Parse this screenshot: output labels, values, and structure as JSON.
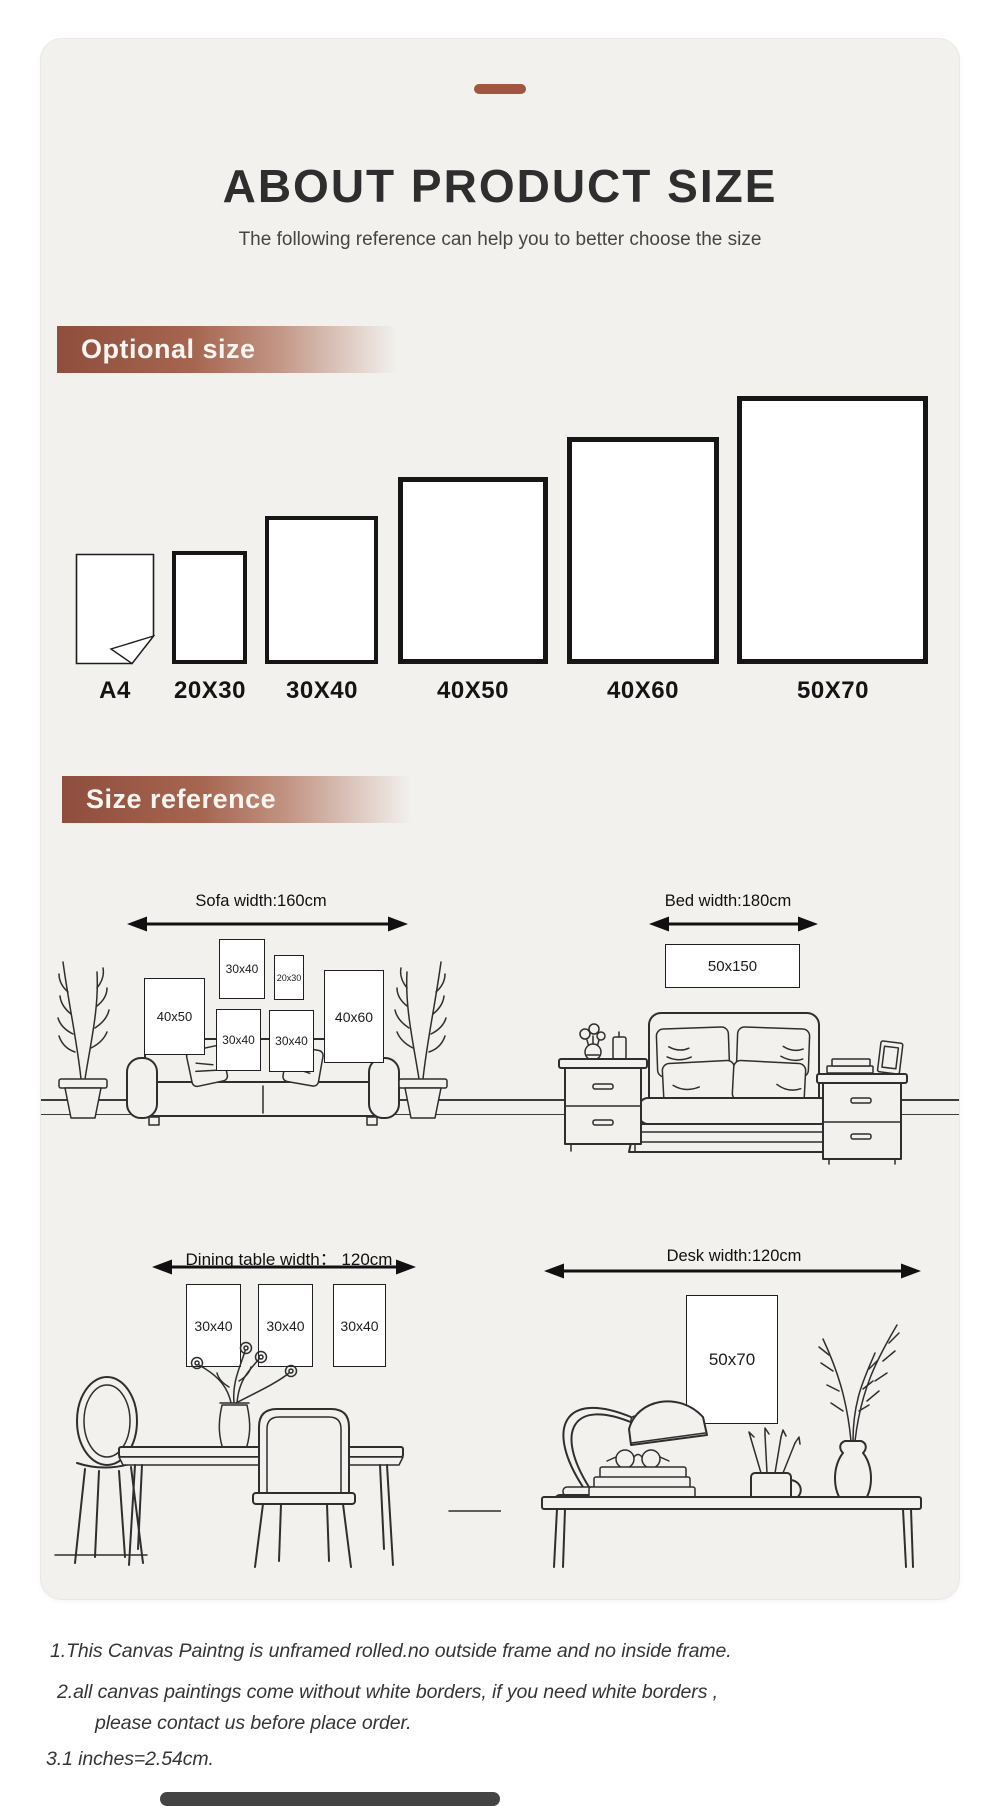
{
  "header": {
    "title": "ABOUT PRODUCT SIZE",
    "subtitle": "The following reference can help you to better choose the size"
  },
  "optional_size": {
    "label": "Optional size",
    "sizes": [
      "A4",
      "20X30",
      "30X40",
      "40X50",
      "40X60",
      "50X70"
    ]
  },
  "size_reference": {
    "label": "Size reference",
    "scenes": {
      "sofa": {
        "title": "Sofa width:160cm",
        "frames": [
          "40x50",
          "30x40",
          "20x30",
          "30x40",
          "30x40",
          "40x60"
        ]
      },
      "bed": {
        "title": "Bed width:180cm",
        "frame": "50x150"
      },
      "dining": {
        "title": "Dining table width：  120cm",
        "frames": [
          "30x40",
          "30x40",
          "30x40"
        ]
      },
      "desk": {
        "title": "Desk width:120cm",
        "frame": "50x70"
      }
    }
  },
  "notes": {
    "lines": [
      "1.This Canvas Paintng is unframed rolled.no outside frame and no inside frame.",
      "2.all canvas paintings come without white borders, if you need white borders ,",
      "please contact us before place order.",
      "3.1 inches=2.54cm."
    ]
  },
  "colors": {
    "accent_brown": "#a2553f",
    "section_bar_brown": "#8f4e3d",
    "card_background": "#f2f1ee",
    "line_ink": "#2e2e2e"
  }
}
